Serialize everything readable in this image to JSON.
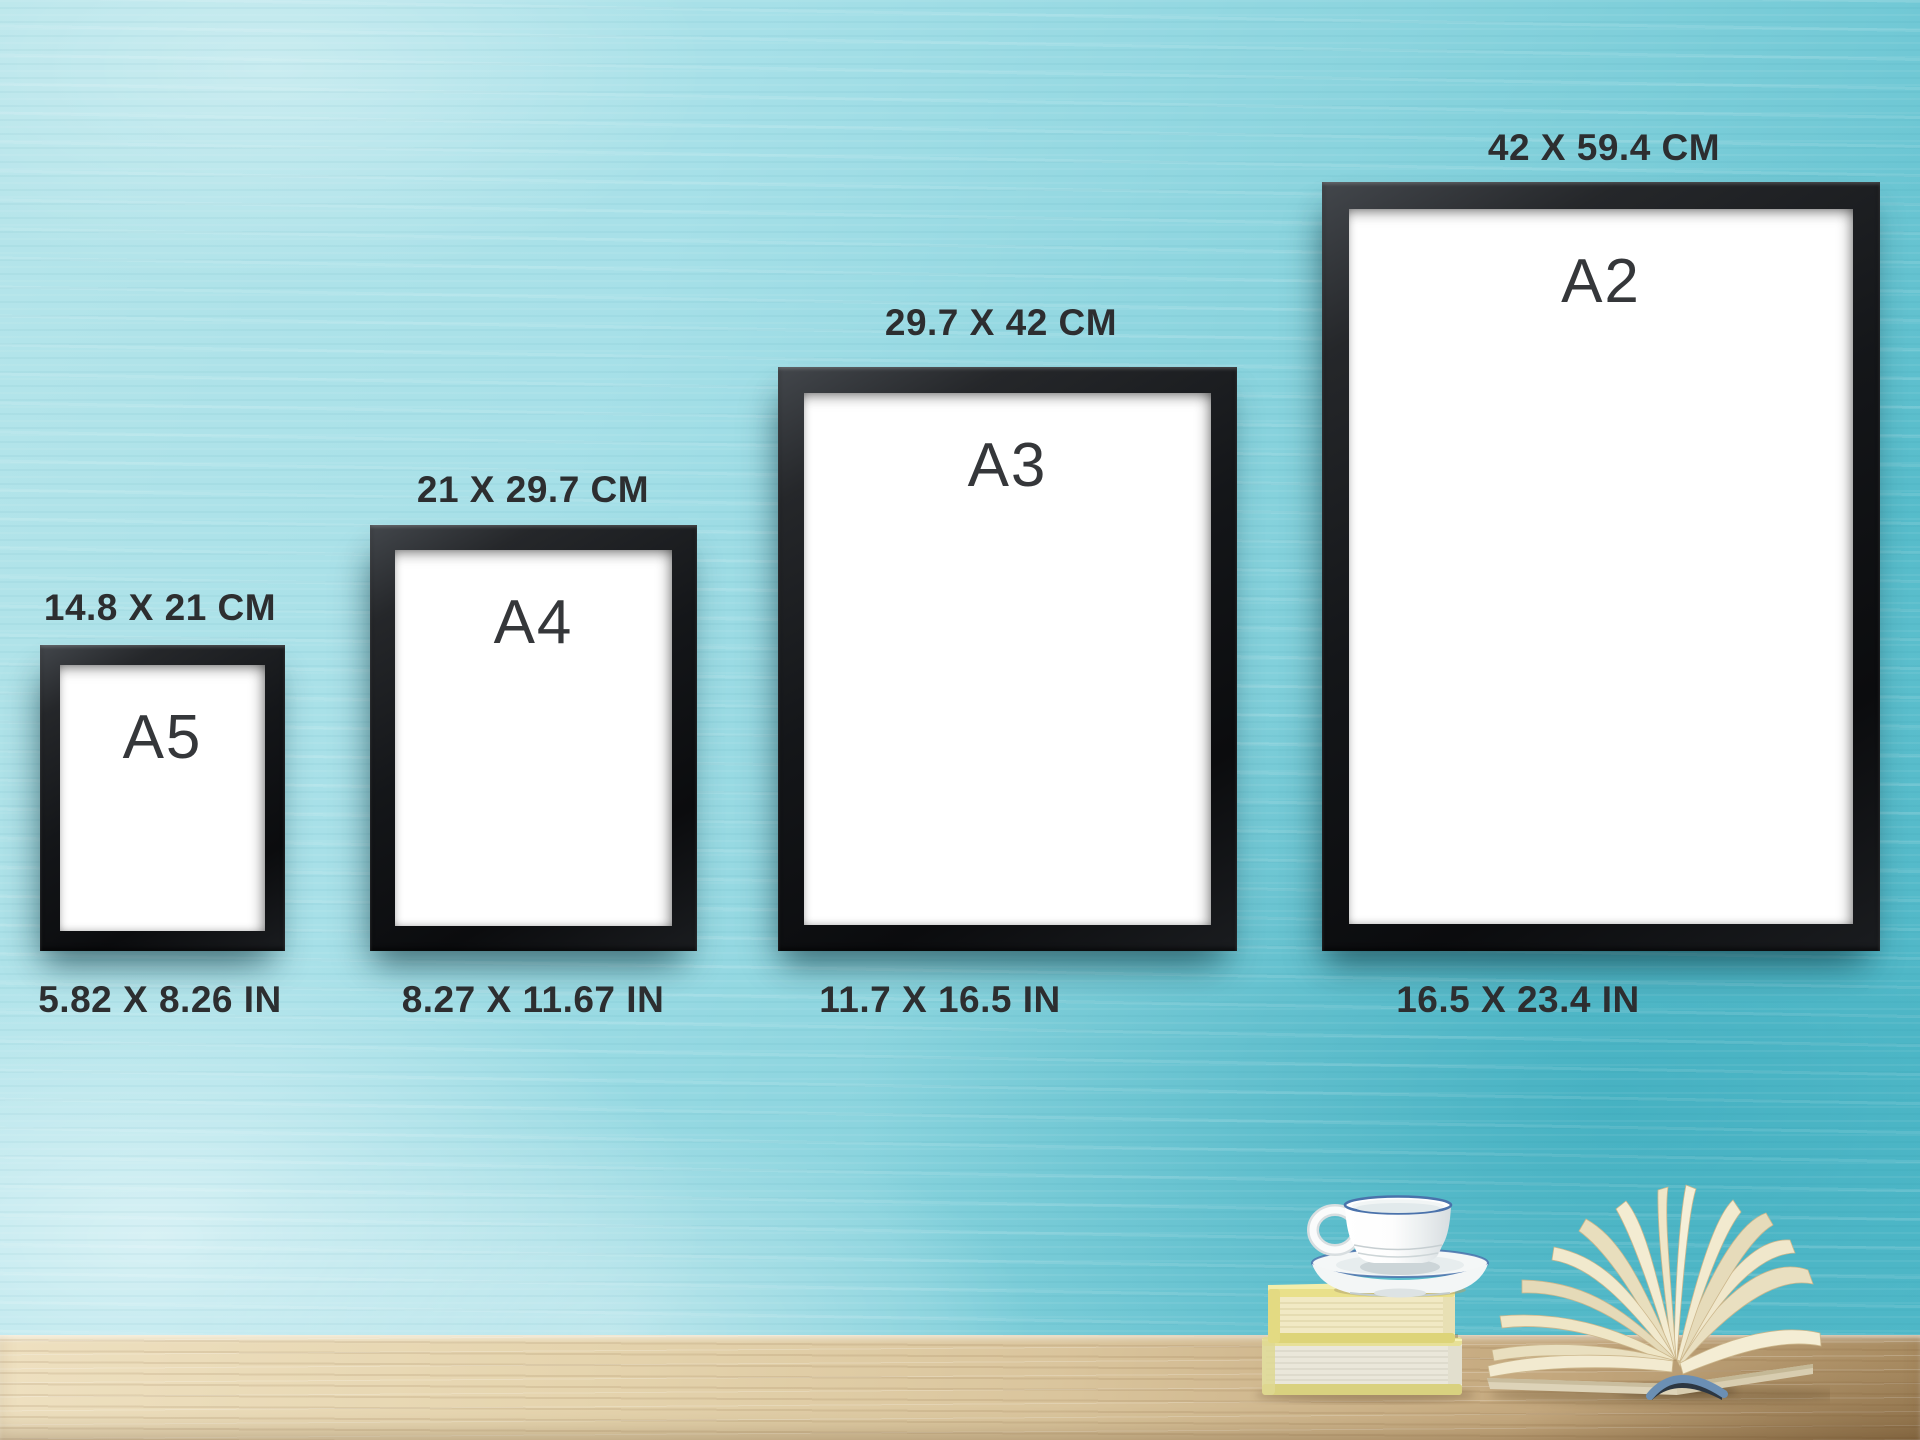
{
  "scene": {
    "description": "Poster frame size comparison chart on a turquoise painted wall above a wooden table",
    "wall_color": "#8bd4de",
    "table_color": "#dac59d",
    "frame_color": "#141619",
    "paper_color": "#ffffff",
    "text_color": "#2d2e30"
  },
  "sizes": [
    {
      "name": "A5",
      "cm": "14.8 X 21 CM",
      "inches": "5.82 X 8.26 IN"
    },
    {
      "name": "A4",
      "cm": "21 X 29.7 CM",
      "inches": "8.27 X 11.67 IN"
    },
    {
      "name": "A3",
      "cm": "29.7 X 42 CM",
      "inches": "11.7 X 16.5 IN"
    },
    {
      "name": "A2",
      "cm": "42 X 59.4 CM",
      "inches": "16.5 X 23.4 IN"
    }
  ],
  "props": {
    "cup": "white coffee cup with blue rim on saucer",
    "books": "two stacked yellow books",
    "open_book": "open hardcover book with fanned pages and blue spine"
  },
  "accent_colors": {
    "cup_stripe_blue": "#4a72ab",
    "book_yellow": "#e9e08a",
    "page_cream": "#f1e9c9",
    "spine_blue": "#6b8fb4"
  }
}
